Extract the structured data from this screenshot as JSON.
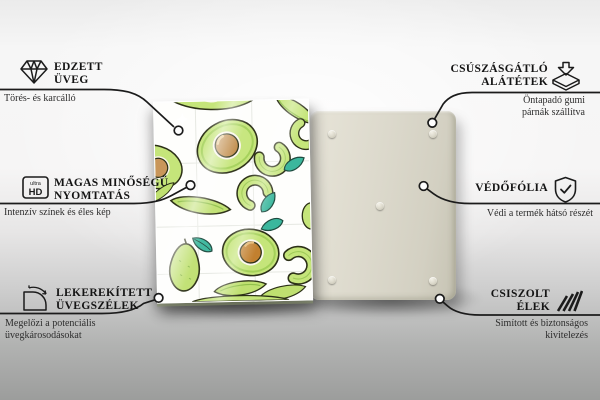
{
  "features": {
    "left": [
      {
        "icon": "diamond-icon",
        "title_line1": "EDZETT",
        "title_line2": "ÜVEG",
        "sub_line1": "Törés- és karcálló",
        "sub_line2": ""
      },
      {
        "icon": "ultra-hd-icon",
        "title_line1": "MAGAS MINŐSÉGŰ",
        "title_line2": "NYOMTATÁS",
        "sub_line1": "Intenzív színek és éles kép",
        "sub_line2": ""
      },
      {
        "icon": "rounded-corner-icon",
        "title_line1": "LEKEREKÍTETT",
        "title_line2": "ÜVEGSZÉLEK",
        "sub_line1": "Megelőzi a potenciális",
        "sub_line2": "üvegkárosodásokat"
      }
    ],
    "right": [
      {
        "icon": "anti-slip-pad-icon",
        "title_line1": "CSÚSZÁSGÁTLÓ",
        "title_line2": "ALÁTÉTEK",
        "sub_line1": "Öntapadó gumi",
        "sub_line2": "párnák szállítva"
      },
      {
        "icon": "shield-check-icon",
        "title_line1": "VÉDŐFÓLIA",
        "title_line2": "",
        "sub_line1": "Védi a termék hátsó részét",
        "sub_line2": ""
      },
      {
        "icon": "polished-edge-icon",
        "title_line1": "CSISZOLT",
        "title_line2": "ÉLEK",
        "sub_line1": "Simított és biztonságos",
        "sub_line2": "kivitelezés"
      }
    ]
  },
  "badges": {
    "ultra_label": "ultra",
    "hd_label": "HD"
  },
  "colors": {
    "avocado_flesh": "#c5e57a",
    "avocado_skin": "#9ece53",
    "pit_brown": "#c08c4a",
    "leaf_teal": "#3bb79d",
    "back_board_beige": "#dcd9cc",
    "line_black": "#1b1b1b"
  }
}
